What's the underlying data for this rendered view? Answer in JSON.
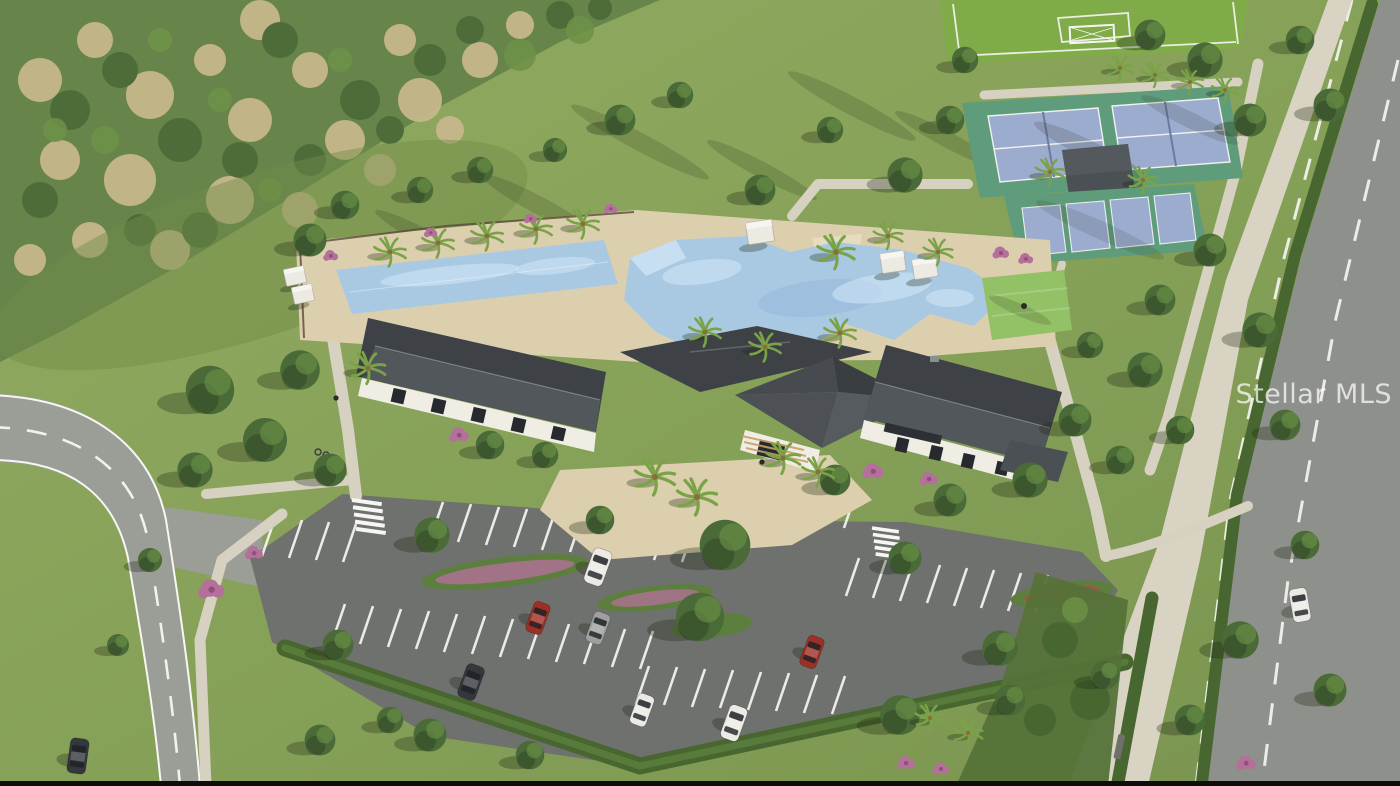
{
  "image": {
    "type": "aerial-3d-architectural-rendering",
    "subject": "Community amenity center: clubhouse with dark roofs, resort-style pool, lap pool, cabanas, tennis courts, pickleball courts, shade pavilion, soccer field, event lawn, landscaped parking lot, perimeter roads with cars and natural preserve"
  },
  "watermark": {
    "text": "Stellar MLS"
  },
  "palette": {
    "grass": "#8aa45c",
    "forest-base": "#67854b",
    "forest-green": "#4d6c3a",
    "forest-brush": "#c6b78b",
    "road": "#9b9d97",
    "road-right": "#8e908b",
    "parking": "#6e716d",
    "sidewalk": "#d8d3c2",
    "path": "#d6d1c0",
    "line-white": "#f6f6f2",
    "deck": "#dbcfae",
    "deck-light": "#e6dcc0",
    "pool": "#a9c9e3",
    "pool-light": "#cfe5f5",
    "pool-deep": "#8fb3d6",
    "roof-dark": "#3e4246",
    "roof-mid": "#4b5054",
    "roof-light": "#565b60",
    "ridge": "#7b8085",
    "wall": "#f0ede5",
    "window": "#26292d",
    "court-green": "#5f9c7c",
    "court-blue": "#9caccf",
    "lawn": "#93c166",
    "field": "#7fab49",
    "hedge": "#48662f",
    "tree": "#4a6b38",
    "tree-light": "#6d9247",
    "palm": "#7aa348",
    "flower-pink": "#b4709a",
    "car-white": "#eceae4",
    "car-red": "#9c2f26",
    "car-silver": "#9da09f",
    "car-dark": "#34383d"
  },
  "scene_elements": [
    "forest-preserve",
    "meadow",
    "left-road",
    "right-road",
    "sidewalks",
    "parking-lot",
    "clubhouse",
    "entry-plaza",
    "main-pool",
    "lap-pool",
    "cabanas",
    "pool-deck",
    "tennis-courts",
    "pickleball-courts",
    "shade-pavilion",
    "soccer-field",
    "event-lawn",
    "hedges",
    "trees",
    "palm-trees",
    "flowering-shrubs",
    "cars",
    "crosswalks",
    "bench",
    "bike-rack"
  ]
}
